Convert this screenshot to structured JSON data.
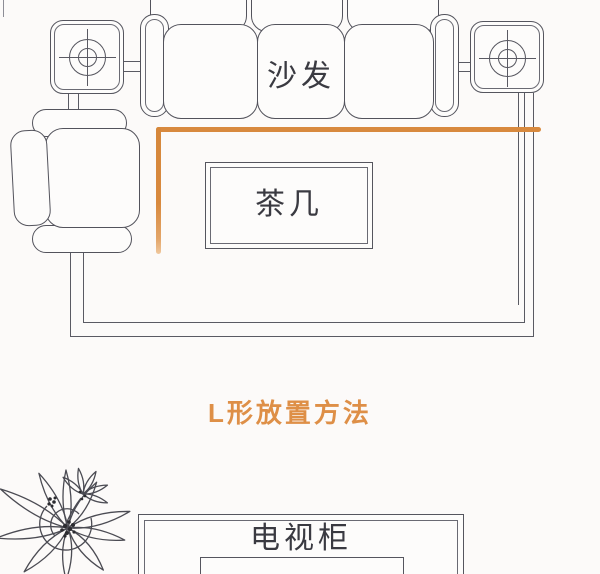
{
  "canvas": {
    "width": 600,
    "height": 574,
    "background": "#fcfaf9"
  },
  "colors": {
    "accent_orange": "#d8893e",
    "title_orange": "#de8f47",
    "line_gray": "#5a5a63",
    "label_text": "#3a3a41"
  },
  "title": {
    "text": "L形放置方法"
  },
  "furniture": {
    "sofa": {
      "label": "沙发"
    },
    "coffee_table": {
      "label": "茶几"
    },
    "tv_cabinet": {
      "label": "电视柜"
    },
    "armchair": {
      "label": ""
    },
    "side_table_left": {
      "icon": "table-lamp-icon"
    },
    "side_table_right": {
      "icon": "table-lamp-icon"
    },
    "plant": {
      "icon": "plant-icon"
    }
  },
  "annotation": {
    "l_shape_color": "#d8893e",
    "l_shape_meaning": "L形放置方法"
  }
}
